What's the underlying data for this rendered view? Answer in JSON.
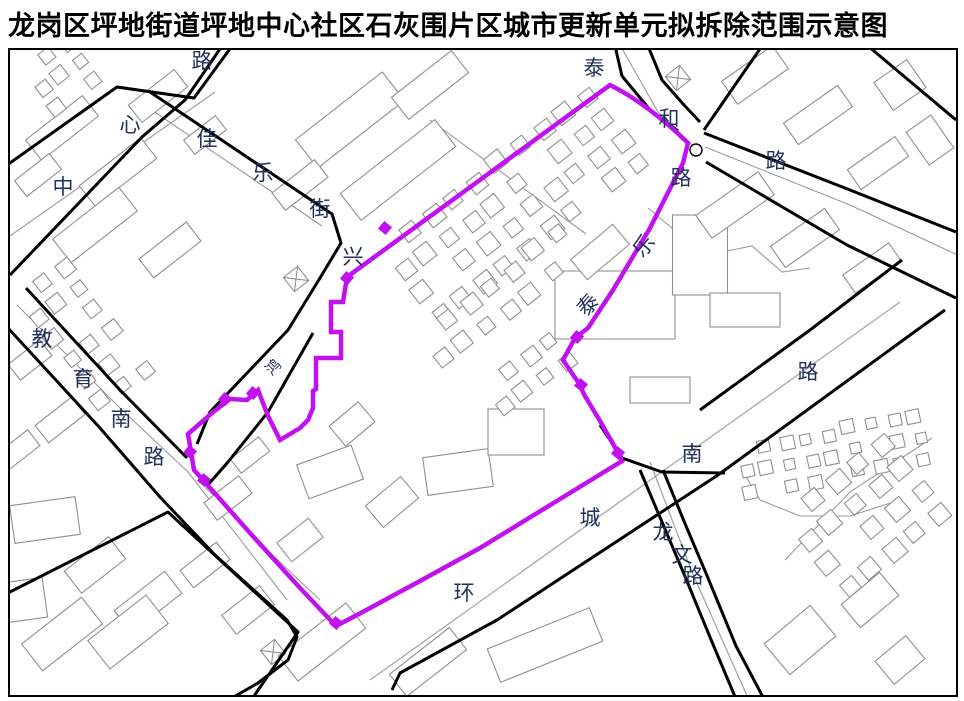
{
  "title": "龙岗区坪地街道坪地中心社区石灰围片区城市更新单元拟拆除范围示意图",
  "colors": {
    "boundary": "#c211f0",
    "road": "#000000",
    "building": "#909090",
    "gray_line": "#9a9a9a",
    "label": "#22305c",
    "frame": "#000000",
    "background": "#ffffff"
  },
  "map": {
    "frame": {
      "x": 9,
      "y": 49,
      "w": 948,
      "h": 647
    },
    "boundary": {
      "name": "拟拆除范围线",
      "path": "M347,277 L610,85 Q648,104 688,143 L683,163 L650,228 L613,290 L588,328 L575,338 L563,360 L578,382 L585,396 L600,421 L612,442 L622,461 L560,499 L480,548 L420,581 L357,615 L336,626 L300,588 L250,533 L204,481 L194,470 L188,434 L212,413 L230,399 L247,400 L258,390 L268,416 L280,440 L300,428 L308,420 L313,408 L313,391 L316,389 L316,358 L341,358 L341,332 L331,332 L331,302 L343,302 Z",
      "markers": [
        [
          385,
          228
        ],
        [
          347,
          278
        ],
        [
          253,
          393
        ],
        [
          225,
          399
        ],
        [
          190,
          452
        ],
        [
          577,
          337
        ],
        [
          581,
          385
        ],
        [
          618,
          453
        ],
        [
          336,
          623
        ],
        [
          204,
          480
        ]
      ]
    },
    "roads": [
      "0,170 117,87 194,98 232,46",
      "10,275 142,137 185,100 222,46",
      "150,92 332,214 341,243 320,278 288,330 210,412 197,444",
      "313,333 268,412 228,462 207,486",
      "26,288 120,390 187,458",
      "8,328 100,428 160,497 215,555 287,620 297,637 288,660 258,683 232,698",
      "0,597 168,512 298,632 252,699",
      "615,46 622,76 650,110 678,131",
      "648,46 662,80 684,105 700,122",
      "762,46 726,98 704,130",
      "704,133 850,190 956,232",
      "706,162 847,245 956,298",
      "700,410 810,330 902,260",
      "392,690 400,673 497,620 718,475 917,330 945,310",
      "600,425 622,458 662,472 725,473",
      "640,470 662,522 684,574 712,642 736,699",
      "663,470 686,526 708,578 736,646 764,699",
      "868,46 956,120"
    ],
    "gray_lines": [
      "0,243 215,92",
      "140,102 322,226",
      "17,305 120,408 188,472 287,600",
      "620,45 658,112 692,145",
      "705,147 850,205 964,258",
      "650,462 692,572 748,698",
      "370,680 900,302",
      "785,560 850,492 932,438",
      "648,208 672,228 694,222 722,252 752,246 782,272 810,268",
      "742,470 760,500 800,516 850,516 900,500",
      "430,120 586,234",
      "205,487 262,545 320,600"
    ],
    "labels": [
      {
        "t": "路",
        "x": 202,
        "y": 61
      },
      {
        "t": "心",
        "x": 130,
        "y": 125
      },
      {
        "t": "中",
        "x": 63,
        "y": 187
      },
      {
        "t": "佳",
        "x": 207,
        "y": 139
      },
      {
        "t": "乐",
        "x": 263,
        "y": 173
      },
      {
        "t": "街",
        "x": 320,
        "y": 209
      },
      {
        "t": "兴",
        "x": 353,
        "y": 257
      },
      {
        "t": "泰",
        "x": 594,
        "y": 68
      },
      {
        "t": "和",
        "x": 669,
        "y": 119
      },
      {
        "t": "路",
        "x": 776,
        "y": 161
      },
      {
        "t": "路",
        "x": 681,
        "y": 178
      },
      {
        "t": "乐",
        "x": 644,
        "y": 246,
        "r": -50
      },
      {
        "t": "泰",
        "x": 588,
        "y": 305,
        "r": -50
      },
      {
        "t": "鸿",
        "x": 274,
        "y": 368,
        "r": -45,
        "s": 15
      },
      {
        "t": "教",
        "x": 42,
        "y": 339
      },
      {
        "t": "育",
        "x": 83,
        "y": 379
      },
      {
        "t": "南",
        "x": 121,
        "y": 419
      },
      {
        "t": "路",
        "x": 154,
        "y": 457
      },
      {
        "t": "环",
        "x": 464,
        "y": 593
      },
      {
        "t": "城",
        "x": 590,
        "y": 518
      },
      {
        "t": "南",
        "x": 692,
        "y": 454
      },
      {
        "t": "路",
        "x": 808,
        "y": 372
      },
      {
        "t": "龙",
        "x": 663,
        "y": 532
      },
      {
        "t": "文",
        "x": 682,
        "y": 555
      },
      {
        "t": "路",
        "x": 693,
        "y": 576
      }
    ],
    "slabs": [
      [
        62,
        128,
        72,
        26,
        -38
      ],
      [
        118,
        172,
        78,
        26,
        -38
      ],
      [
        158,
        96,
        58,
        22,
        -38
      ],
      [
        95,
        225,
        84,
        30,
        -38
      ],
      [
        170,
        250,
        60,
        24,
        -38
      ],
      [
        38,
        175,
        44,
        20,
        -38
      ],
      [
        205,
        135,
        40,
        18,
        -38
      ],
      [
        350,
        120,
        110,
        36,
        -38
      ],
      [
        398,
        170,
        120,
        34,
        -38
      ],
      [
        300,
        185,
        54,
        22,
        -38
      ],
      [
        430,
        85,
        76,
        28,
        -38
      ],
      [
        615,
        305,
        120,
        68,
        0
      ],
      [
        600,
        252,
        55,
        26,
        -40
      ],
      [
        700,
        255,
        55,
        80,
        0
      ],
      [
        745,
        310,
        70,
        34,
        0
      ],
      [
        660,
        390,
        60,
        26,
        0
      ],
      [
        755,
        75,
        62,
        28,
        -35
      ],
      [
        818,
        115,
        66,
        26,
        -35
      ],
      [
        878,
        163,
        58,
        24,
        -35
      ],
      [
        900,
        85,
        40,
        34,
        -35
      ],
      [
        735,
        205,
        76,
        28,
        -35
      ],
      [
        805,
        238,
        66,
        26,
        -35
      ],
      [
        872,
        268,
        56,
        22,
        -35
      ],
      [
        930,
        140,
        30,
        40,
        -35
      ],
      [
        330,
        472,
        58,
        36,
        -20
      ],
      [
        392,
        502,
        46,
        28,
        -40
      ],
      [
        458,
        472,
        66,
        38,
        -8
      ],
      [
        516,
        432,
        56,
        46,
        0
      ],
      [
        352,
        424,
        38,
        26,
        -40
      ],
      [
        300,
        540,
        40,
        24,
        -38
      ],
      [
        30,
        360,
        40,
        20,
        -38
      ],
      [
        60,
        420,
        46,
        22,
        -38
      ],
      [
        18,
        450,
        40,
        20,
        -38
      ],
      [
        45,
        520,
        66,
        38,
        -8
      ],
      [
        95,
        565,
        56,
        28,
        -38
      ],
      [
        148,
        602,
        64,
        28,
        -38
      ],
      [
        62,
        634,
        76,
        34,
        -38
      ],
      [
        205,
        565,
        46,
        22,
        -38
      ],
      [
        25,
        600,
        40,
        40,
        -8
      ],
      [
        128,
        632,
        74,
        36,
        -38
      ],
      [
        322,
        642,
        86,
        32,
        -38
      ],
      [
        428,
        662,
        76,
        28,
        -38
      ],
      [
        545,
        645,
        110,
        36,
        -22
      ],
      [
        248,
        610,
        48,
        24,
        -38
      ],
      [
        228,
        498,
        44,
        22,
        -38
      ],
      [
        250,
        455,
        36,
        18,
        -38
      ],
      [
        800,
        640,
        60,
        40,
        -40
      ],
      [
        870,
        600,
        50,
        30,
        -40
      ],
      [
        900,
        660,
        40,
        30,
        -40
      ]
    ],
    "clusters": [
      {
        "x": 388,
        "y": 250,
        "angle": -38,
        "cols": 10,
        "rows": 4,
        "sp": 28,
        "size": 16
      },
      {
        "x": 425,
        "y": 338,
        "angle": -38,
        "cols": 7,
        "rows": 2,
        "sp": 28,
        "size": 15
      },
      {
        "x": 742,
        "y": 452,
        "angle": -12,
        "cols": 9,
        "rows": 3,
        "sp": 22,
        "size": 12
      },
      {
        "x": 790,
        "y": 520,
        "angle": -40,
        "cols": 5,
        "rows": 4,
        "sp": 30,
        "size": 17
      },
      {
        "x": 22,
        "y": 300,
        "angle": -38,
        "cols": 3,
        "rows": 6,
        "sp": 26,
        "size": 14
      },
      {
        "x": 28,
        "y": 72,
        "angle": -38,
        "cols": 3,
        "rows": 3,
        "sp": 24,
        "size": 13
      },
      {
        "x": 488,
        "y": 388,
        "angle": -38,
        "cols": 4,
        "rows": 2,
        "sp": 26,
        "size": 14
      }
    ],
    "crosses": [
      [
        296,
        279
      ],
      [
        273,
        652
      ],
      [
        678,
        78
      ]
    ],
    "circles": [
      [
        696,
        150,
        6
      ]
    ]
  }
}
